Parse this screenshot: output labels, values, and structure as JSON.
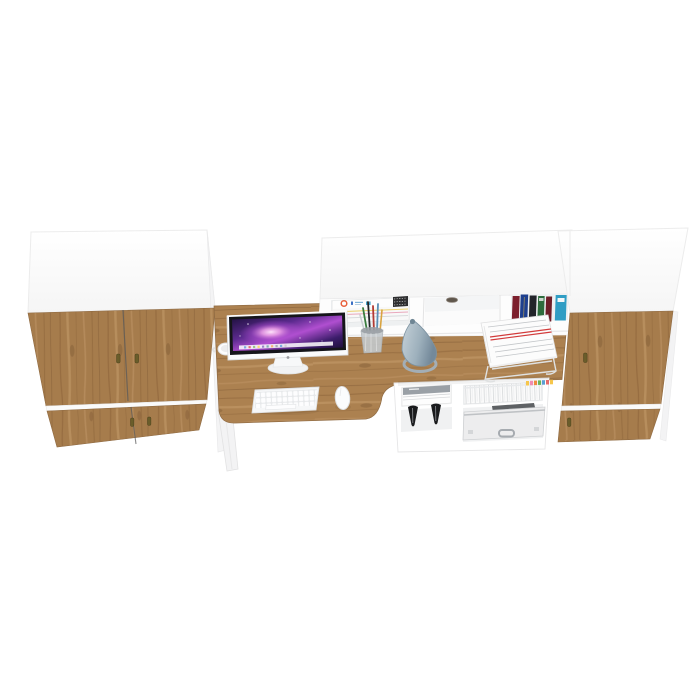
{
  "meta": {
    "kind": "3d-product-render",
    "description": "White and oak home-office wall unit: two wardrobes flanking a desk with overhead hutch, styled with computer and accessories, on a plain white background",
    "view": "high top-front perspective"
  },
  "palette": {
    "bg": "#ffffff",
    "panel-white": "#fdfdfd",
    "panel-shadow": "#f1f1f2",
    "edge": "#ededed",
    "wood": "#a67c4c",
    "wood-desk": "#ac8150",
    "wood-light": "#c59c6c",
    "wood-dark": "#8a6138",
    "wood-deep": "#6e4c2b",
    "seam": "#5a5a5a",
    "handle": "#6a5d2a",
    "screen-dark": "#1a0e38",
    "screen-violet": "#5b2a8e",
    "screen-magenta": "#b04fd0",
    "burst": "#ffe3fb",
    "lamp-light": "#c6d2d9",
    "lamp-mid": "#9db0bc",
    "lamp-dark": "#74899a",
    "black": "#1a1b1d",
    "case-silver": "#ededee",
    "red-stripe": "#d23b3b",
    "book-1": "#7c1f2d",
    "book-2": "#1e3f8e",
    "book-3": "#22242a",
    "book-4": "#2d6b3c",
    "book-5": "#6d1d28",
    "book-6": "#2f9dc4",
    "tab-1": "#f6c64b",
    "tab-2": "#f08bb1",
    "tab-3": "#ee8b3e",
    "tab-4": "#67b55b",
    "tab-5": "#5a9fd4",
    "tab-6": "#e76b6b"
  },
  "scene": {
    "objects": {
      "left_wardrobe": {
        "label": "left wardrobe, white carcass with four oak doors and brass drop handles",
        "doors": 4,
        "handles": 4
      },
      "right_wardrobe": {
        "label": "right wardrobe, white carcass with two oak doors and brass drop handles",
        "doors": 2,
        "handles": 2
      },
      "hutch": {
        "label": "white overhead hutch with three open cubbies",
        "cubbies": 3
      },
      "desk": {
        "label": "oak desk top with curved cutout and white leg"
      },
      "imac": {
        "label": "all-in-one computer showing purple galaxy wallpaper with dock"
      },
      "keyboard": {
        "label": "white wireless keyboard"
      },
      "mouse": {
        "label": "white mouse"
      },
      "mug": {
        "label": "white mug behind the display"
      },
      "pen_cup": {
        "label": "mesh pen cup with pens and pencils"
      },
      "lamp": {
        "label": "grey-blue cone desk lamp on ring base"
      },
      "document_tray": {
        "label": "white wire tray stacked with printed documents with red stripes"
      },
      "hutch_magazines": {
        "label": "stack of magazines in left cubby with orange logo cover"
      },
      "grommet": {
        "label": "dark cable grommet in middle cubby"
      },
      "books": {
        "label": "row of six books in right cubby",
        "count": 6,
        "colors": [
          "#7c1f2d",
          "#1e3f8e",
          "#22242a",
          "#2d6b3c",
          "#6d1d28",
          "#2f9dc4"
        ]
      },
      "under_shelf": {
        "label": "open white shelf unit below desk"
      },
      "shelf_magazines": {
        "label": "stack of grey magazines on lower shelf"
      },
      "heels": {
        "label": "pair of black high-heel shoes",
        "count": 2
      },
      "files": {
        "label": "folded white files with coloured index tabs"
      },
      "sticky_tabs": {
        "label": "coloured page-marker tabs",
        "colors": [
          "#f6c64b",
          "#f08bb1",
          "#ee8b3e",
          "#67b55b",
          "#5a9fd4",
          "#e76b6b"
        ]
      },
      "briefcase": {
        "label": "aluminium briefcase with handle"
      },
      "dark_bag": {
        "label": "dark case behind briefcase"
      }
    }
  }
}
